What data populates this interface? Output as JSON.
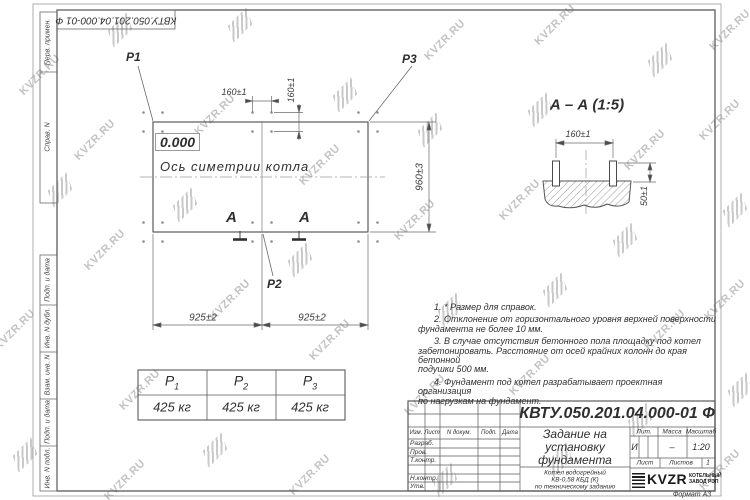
{
  "watermark": {
    "text": "KVZR.RU"
  },
  "stamp": {
    "doc_number": "КВТУ.050.201.04.000-01 Ф"
  },
  "side_labels": {
    "top": [
      "Перв. примен.",
      "Справ. N"
    ],
    "bottom": [
      "Подп. и дата",
      "Инв. N дубл.",
      "Взам. инв. N",
      "Подп. и дата",
      "Инв. N подл."
    ]
  },
  "plan": {
    "p1": "P1",
    "p2": "P2",
    "p3": "P3",
    "elevation": "0.000",
    "axis_label": "Ось симетрии котла",
    "section_letter": "A",
    "dim_bolt_h": "160±1",
    "dim_bolt_v": "160±1",
    "dim_span_left": "925±2",
    "dim_span_right": "925±2",
    "dim_height": "960±3"
  },
  "section_view": {
    "title": "А – А (1:5)",
    "dim_spacing": "160±1",
    "dim_height": "50±1"
  },
  "notes": [
    "1. * Размер для справок.",
    "2. Отклонение от горизонтального уровня верхней поверхности",
    "фундамента не более 10 мм.",
    "3. В случае отсутствия бетонного пола площадку под котел",
    "забетонировать. Расстояние от осей крайних колонн до края бетонной",
    "подушки 500 мм.",
    "4. Фундамент под котел разрабатывает проектная организация",
    "по нагрузкам на фундамент."
  ],
  "load_table": {
    "headers": [
      {
        "letter": "P",
        "sub": "1"
      },
      {
        "letter": "P",
        "sub": "2"
      },
      {
        "letter": "P",
        "sub": "3"
      }
    ],
    "values": [
      "425 кг",
      "425 кг",
      "425 кг"
    ]
  },
  "title_block": {
    "doc_number": "КВТУ.050.201.04.000-01 Ф",
    "title_lines": [
      "Задание на",
      "установку",
      "фундамента"
    ],
    "subtitle_lines": [
      "Котел водогрейный",
      "КВ-0,58 КБД (К)",
      "по техническому заданию"
    ],
    "header_cols": [
      "Изм.",
      "Лист",
      "N докум.",
      "Подп.",
      "Дата"
    ],
    "row_labels": [
      "Разраб.",
      "Пров.",
      "Т.контр.",
      "Н.контр.",
      "Утв."
    ],
    "lit_label": "Лит.",
    "lit_value": "И",
    "mass_label": "Масса",
    "mass_value": "–",
    "scale_label": "Масштаб",
    "scale_value": "1:20",
    "sheet_label": "Лист",
    "sheets_label": "Листов",
    "sheets_value": "1",
    "brand": "KVZR",
    "brand_sub": [
      "КОТЕЛЬНЫЙ",
      "ЗАВОД РЭП"
    ],
    "format": "Формат А3"
  }
}
